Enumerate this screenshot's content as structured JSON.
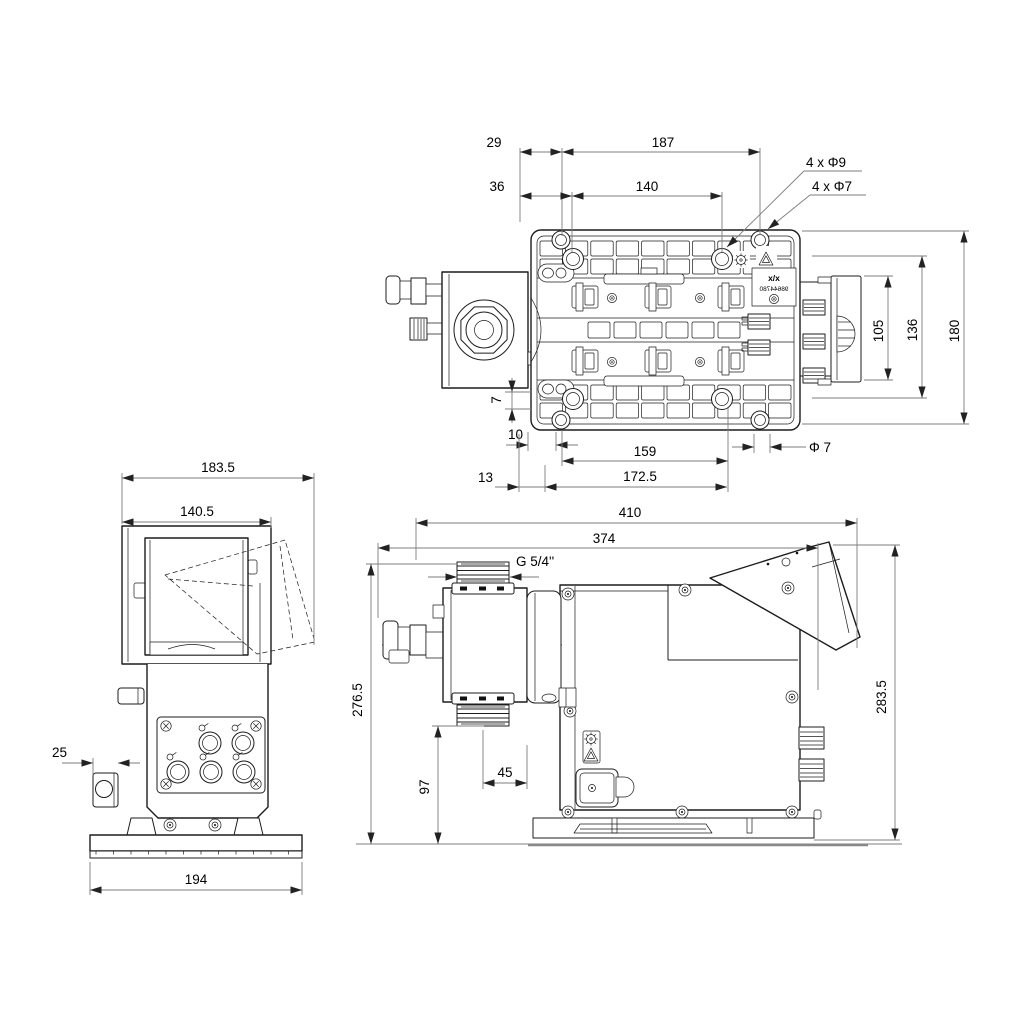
{
  "top_view": {
    "dims": {
      "d29": "29",
      "d187": "187",
      "d36": "36",
      "d140": "140",
      "d105": "105",
      "d136": "136",
      "d180": "180",
      "d7": "7",
      "d10": "10",
      "d159": "159",
      "d13": "13",
      "d172_5": "172.5"
    },
    "callouts": {
      "holes_phi9": "4 x Φ9",
      "holes_phi7": "4 x Φ7",
      "phi7": "Φ 7"
    },
    "nameplate": {
      "line1": "x/x",
      "line2": "98644780"
    },
    "icons": {
      "impeller": "impeller-icon",
      "warning": "warning-triangle-icon"
    }
  },
  "front_view": {
    "dims": {
      "d183_5": "183.5",
      "d140_5": "140.5",
      "d25": "25",
      "d194": "194"
    }
  },
  "side_view": {
    "dims": {
      "d410": "410",
      "d374": "374",
      "d276_5": "276.5",
      "d283_5": "283.5",
      "d97": "97",
      "d45": "45"
    },
    "callouts": {
      "thread": "G 5/4''"
    }
  },
  "colors": {
    "line": "#1c1c1c",
    "dim": "#7d7d7d",
    "text": "#000000",
    "bg": "#ffffff"
  }
}
